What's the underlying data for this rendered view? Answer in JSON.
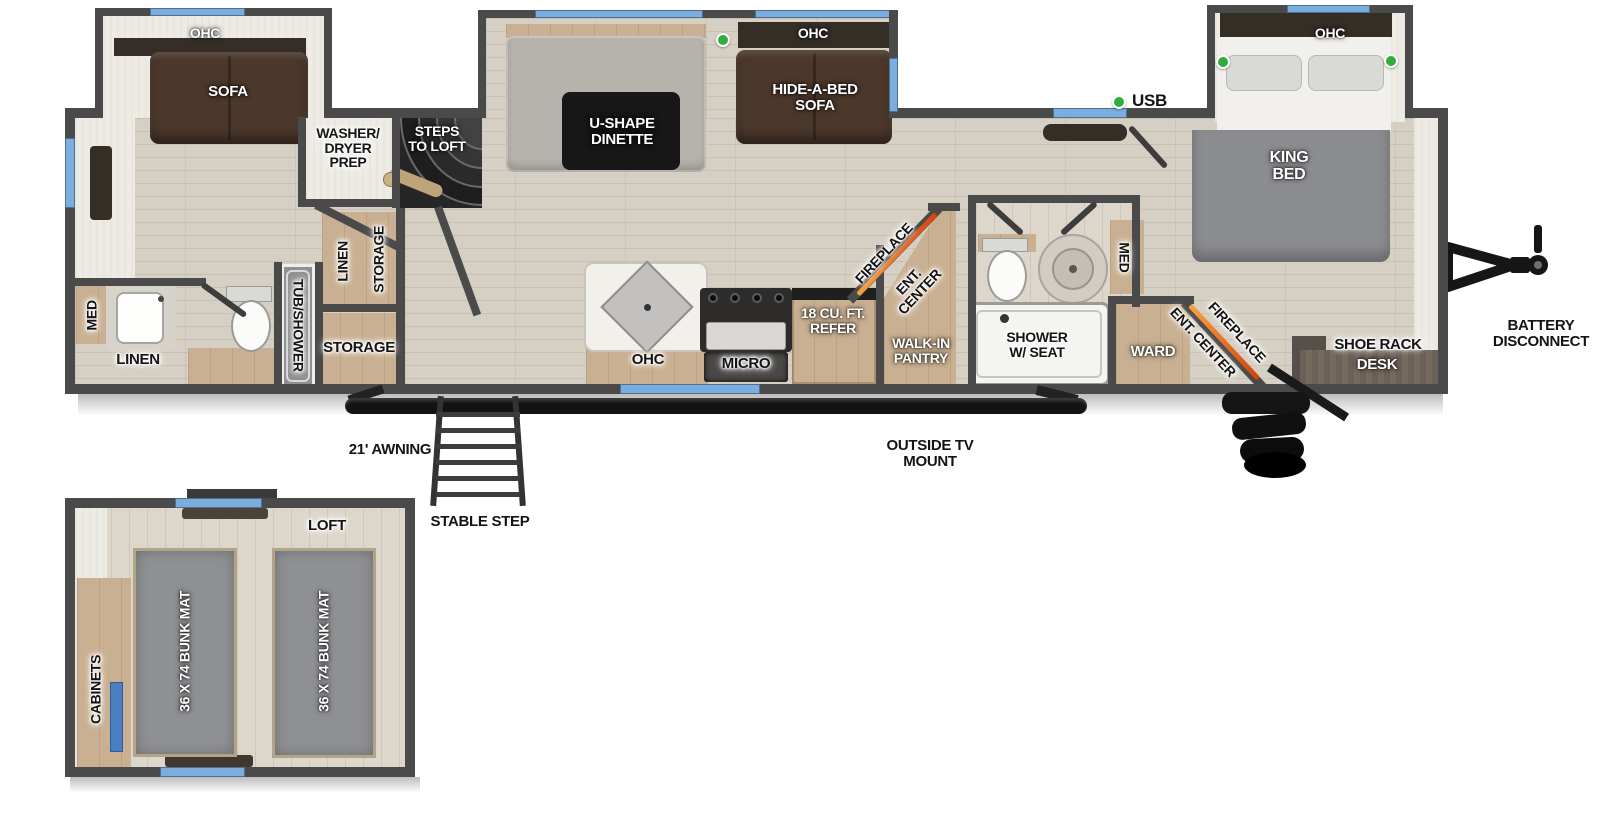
{
  "colors": {
    "wall_gray": "#4a4a4a",
    "window_blue": "#7badde",
    "usb_green": "#2fae3a",
    "fireplace_orange": "#d5420e",
    "floor_wood": "#d6cfc3",
    "cabinet_tan": "#c9b092"
  },
  "labels": {
    "rear_slide_ohc": "OHC",
    "rear_slide_sofa": "SOFA",
    "washer_dryer": "WASHER/ DRYER PREP",
    "steps_to_loft": "STEPS TO LOFT",
    "dinette": "U-SHAPE DINETTE",
    "dinette_ohc": "OHC",
    "hide_a_bed": "HIDE-A-BED SOFA",
    "usb": "USB",
    "king_ohc": "OHC",
    "king_bed": "KING BED",
    "rear_bath_med": "MED",
    "rear_bath_linen": "LINEN",
    "tub_shower": "TUB/SHOWER",
    "closet_linen": "LINEN",
    "closet_storage": "STORAGE",
    "storage_room": "STORAGE",
    "kitchen_ohc": "OHC",
    "micro": "MICRO",
    "refer": "18 CU. FT. REFER",
    "kitchen_fireplace": "FIREPLACE",
    "kitchen_ent_center": "ENT. CENTER",
    "walk_in_pantry": "WALK-IN PANTRY",
    "shower_seat": "SHOWER W/ SEAT",
    "bath_med": "MED",
    "ward": "WARD",
    "bed_ent_center": "ENT. CENTER",
    "bed_fireplace": "FIREPLACE",
    "shoe_rack": "SHOE RACK",
    "desk": "DESK",
    "battery_disconnect": "BATTERY DISCONNECT",
    "awning": "21' AWNING",
    "stable_step": "STABLE STEP",
    "outside_tv": "OUTSIDE TV MOUNT",
    "loft": "LOFT",
    "cabinets": "CABINETS",
    "bunk_mat_left": "36 X 74 BUNK MAT",
    "bunk_mat_right": "36 X 74 BUNK MAT"
  }
}
